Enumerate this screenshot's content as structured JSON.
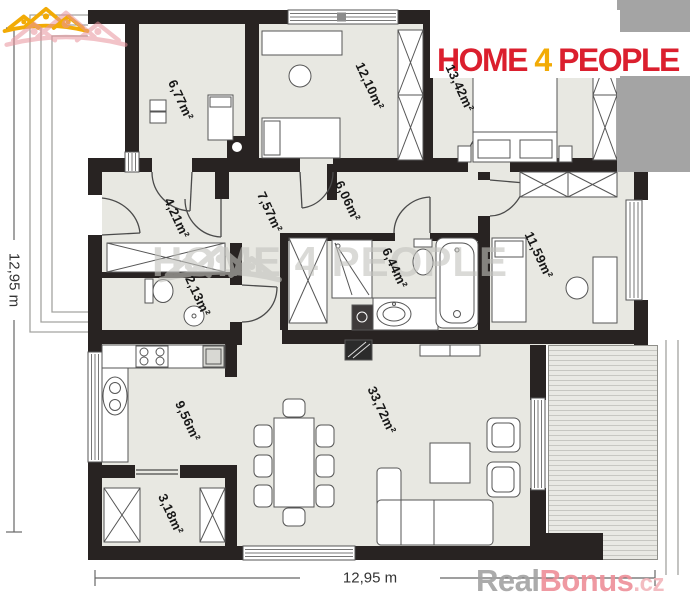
{
  "page": {
    "width": 690,
    "height": 600,
    "background": "#ffffff",
    "type": "floor-plan"
  },
  "branding": {
    "logo": {
      "word1": "HOME",
      "word2": "4",
      "word3": "PEOPLE",
      "text_color": "#db1f2e",
      "accent_color": "#f2ab06",
      "icon": "houses-people-icon"
    },
    "center_watermark": {
      "text": "HOME 4 PEOPLE",
      "color": "#c3c3be"
    },
    "corner_watermark": {
      "part1": "Real",
      "part2": "Bonus",
      "part3": ".cz",
      "part1_color": "#a3a3a3",
      "part2_color": "#ee8e98",
      "part3_color": "#f2b5bb"
    }
  },
  "dimensions": {
    "left_total": "12,95 m",
    "bottom_total": "12,95 m"
  },
  "rooms": [
    {
      "id": "room-677",
      "area": "6,77m²"
    },
    {
      "id": "room-1210",
      "area": "12,10m²"
    },
    {
      "id": "room-1342",
      "area": "13,42m²"
    },
    {
      "id": "hall-421",
      "area": "4,21m²"
    },
    {
      "id": "corridor-757",
      "area": "7,57m²"
    },
    {
      "id": "hall-606",
      "area": "6,06m²"
    },
    {
      "id": "wc-213",
      "area": "2,13m²"
    },
    {
      "id": "bath-644",
      "area": "6,44m²"
    },
    {
      "id": "room-1159",
      "area": "11,59m²"
    },
    {
      "id": "kitchen-956",
      "area": "9,56m²"
    },
    {
      "id": "living-3372",
      "area": "33,72m²"
    },
    {
      "id": "storage-318",
      "area": "3,18m²"
    }
  ],
  "palette": {
    "wall": "#282322",
    "floor": "#e8e8e2",
    "terrace_stripe": "#c7c7c2",
    "furniture_outline": "#565656",
    "dimension_line": "#666666"
  }
}
